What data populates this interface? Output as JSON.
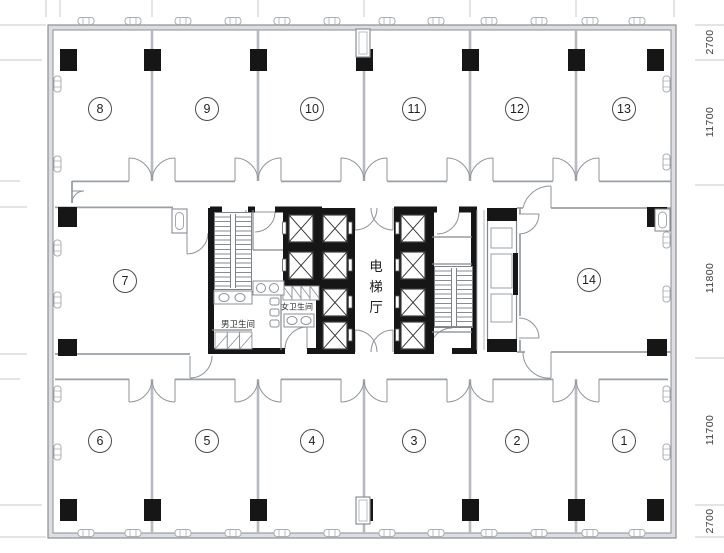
{
  "plan": {
    "title_hint": "office floor plan",
    "rooms": [
      {
        "number": "8"
      },
      {
        "number": "9"
      },
      {
        "number": "10"
      },
      {
        "number": "11"
      },
      {
        "number": "12"
      },
      {
        "number": "13"
      },
      {
        "number": "7"
      },
      {
        "number": "14"
      },
      {
        "number": "6"
      },
      {
        "number": "5"
      },
      {
        "number": "4"
      },
      {
        "number": "3"
      },
      {
        "number": "2"
      },
      {
        "number": "1"
      }
    ],
    "core": {
      "elevator_hall": "电梯厅",
      "womens_restroom": "女卫生间",
      "mens_restroom": "男卫生间"
    },
    "dimensions": {
      "right": [
        "2700",
        "11700",
        "11800",
        "11700",
        "2700"
      ]
    },
    "colors": {
      "structure_black": "#161616",
      "wall_gray": "#9aa0a5",
      "tick_gray": "#c6cacd"
    }
  }
}
